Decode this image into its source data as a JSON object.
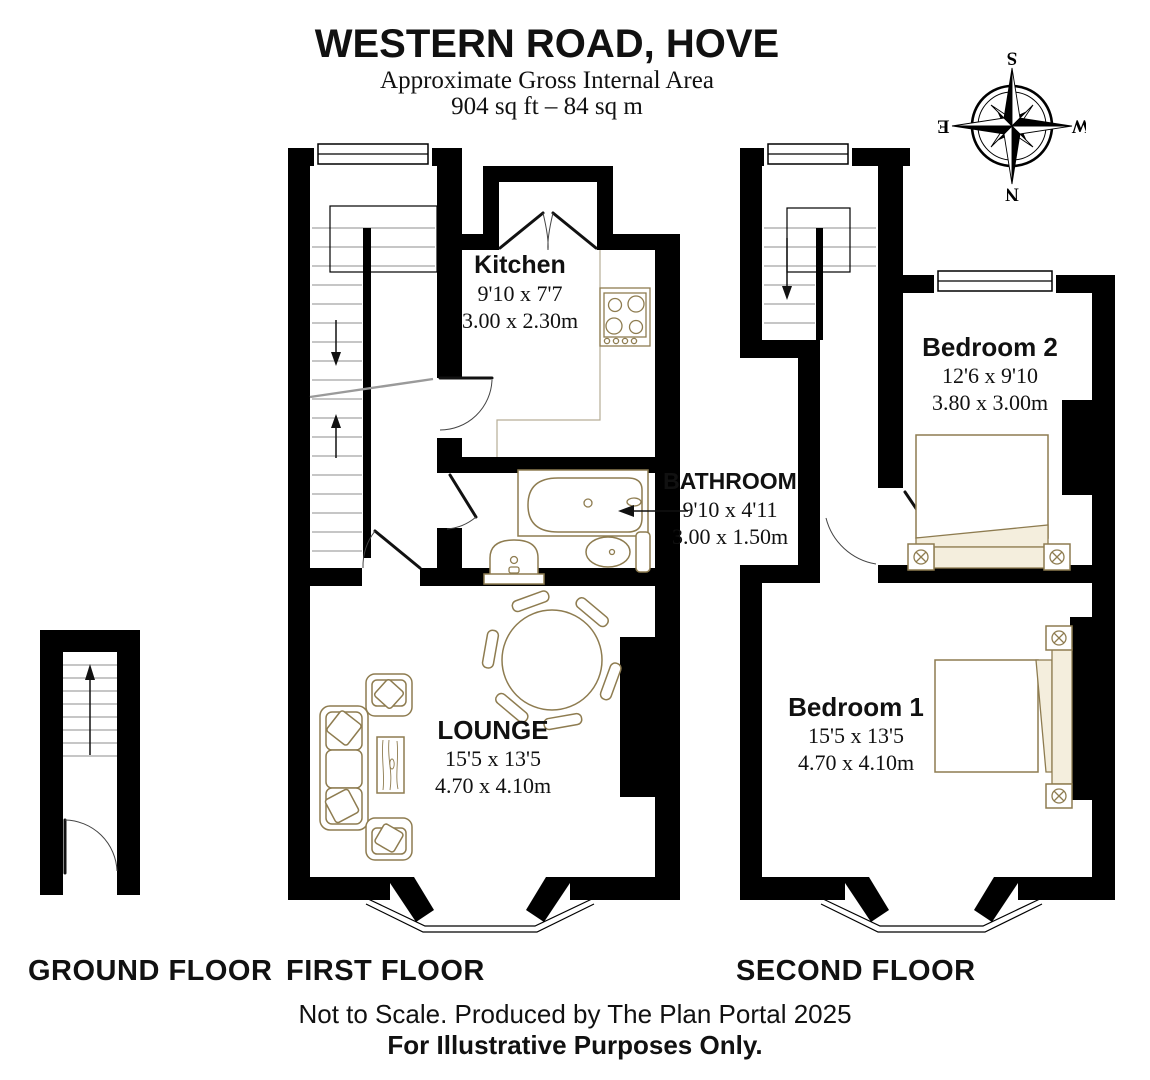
{
  "header": {
    "title": "WESTERN ROAD, HOVE",
    "subtitle": "Approximate Gross Internal Area",
    "area": "904 sq ft – 84 sq m"
  },
  "compass": {
    "n": "N",
    "e": "E",
    "s": "S",
    "w": "W"
  },
  "rooms": {
    "kitchen": {
      "name": "Kitchen",
      "imperial": "9'10 x 7'7",
      "metric": "3.00 x 2.30m"
    },
    "bathroom": {
      "name": "BATHROOM",
      "imperial": "9'10 x 4'11",
      "metric": "3.00 x 1.50m"
    },
    "lounge": {
      "name": "LOUNGE",
      "imperial": "15'5 x 13'5",
      "metric": "4.70 x 4.10m"
    },
    "bedroom2": {
      "name": "Bedroom 2",
      "imperial": "12'6 x 9'10",
      "metric": "3.80 x 3.00m"
    },
    "bedroom1": {
      "name": "Bedroom 1",
      "imperial": "15'5 x 13'5",
      "metric": "4.70 x 4.10m"
    }
  },
  "floors": {
    "ground": "GROUND FLOOR",
    "first": "FIRST FLOOR",
    "second": "SECOND FLOOR"
  },
  "footer": {
    "line1": "Not to Scale. Produced by The Plan Portal 2025",
    "line2": "For Illustrative Purposes Only."
  },
  "colors": {
    "wall": "#000000",
    "furniture_line": "#8e7c50",
    "bedding_fill": "#f4eedd"
  },
  "icons": {
    "compass": "compass-rose",
    "stairs": "stair-treads-with-direction-arrow",
    "bay_window": "angled-bay-window",
    "fixtures": [
      "bathtub-icon",
      "basin-icon",
      "toilet-icon",
      "hob-icon",
      "sofa-icon",
      "armchair-icon",
      "coffee-table-icon",
      "dining-table-icon",
      "double-bed-icon"
    ]
  }
}
